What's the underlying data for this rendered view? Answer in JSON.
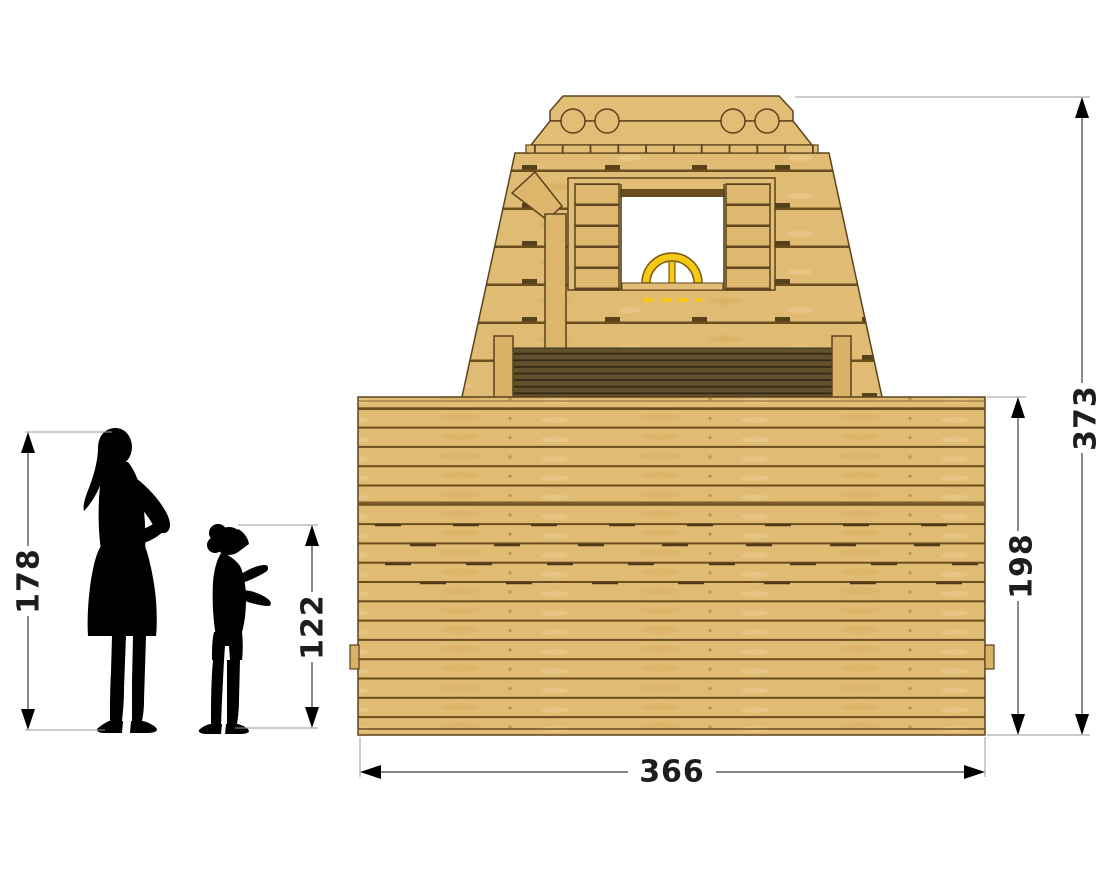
{
  "diagram": {
    "dimensions": {
      "adult_height": "178",
      "child_height": "122",
      "structure_total_height": "373",
      "front_wall_height": "198",
      "structure_width": "366"
    },
    "colors": {
      "background": "#ffffff",
      "wood": "#e0bb73",
      "wood_edge": "#5a431c",
      "plank_line": "#6b4e1e",
      "dark_slats": "#63512e",
      "slat_line": "#352b16",
      "wheel_yellow": "#f6c916",
      "silhouette": "#000000",
      "dimension_line": "#3d3d3d",
      "extension_line": "#9a9a9a"
    }
  }
}
